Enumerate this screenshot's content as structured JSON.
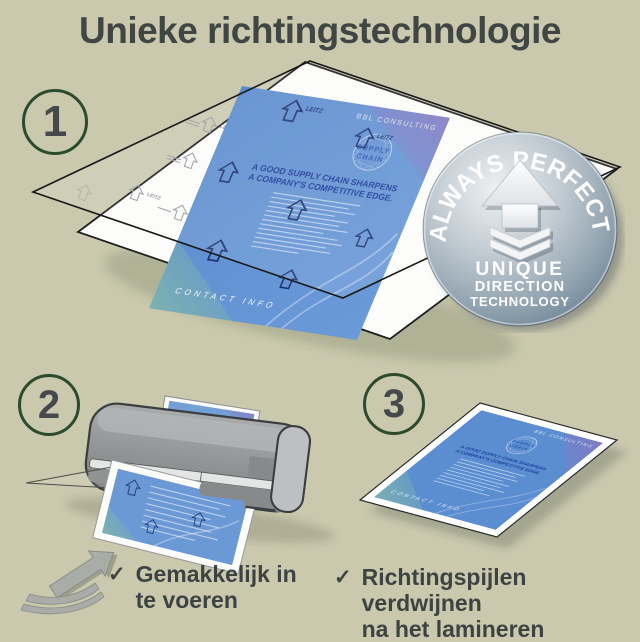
{
  "title": "Unieke richtingstechnologie",
  "badge": {
    "arc": "ALWAYS PERFECT!",
    "line1": "UNIQUE",
    "line2": "DIRECTION",
    "line3": "TECHNOLOGY"
  },
  "steps": {
    "one": {
      "number": "1"
    },
    "two": {
      "number": "2",
      "check": "✓",
      "caption_line1": "Gemakkelijk in",
      "caption_line2": "te voeren"
    },
    "three": {
      "number": "3",
      "check": "✓",
      "caption_line1": "Richtingspijlen verdwijnen",
      "caption_line2": "na het lamineren"
    }
  },
  "document": {
    "brand": "BBL CONSULTING",
    "logo_line1": "SUPPLY",
    "logo_line2": "CHAIN",
    "heading_line1": "A GOOD SUPPLY CHAIN SHARPENS",
    "heading_line2": "A COMPANY'S COMPETITIVE EDGE.",
    "footer": "CONTACT INFO",
    "arrow_brand": "LEITZ"
  },
  "colors": {
    "background": "#cac9ae",
    "heading_text": "#3f4643",
    "circle_ring": "#2c4a2e",
    "document_blue": "#5e90d2",
    "document_navy": "#1d3f9c",
    "badge_light": "#dde4e9",
    "badge_dark": "#4e6679",
    "machine_grey": "#8f9193"
  }
}
